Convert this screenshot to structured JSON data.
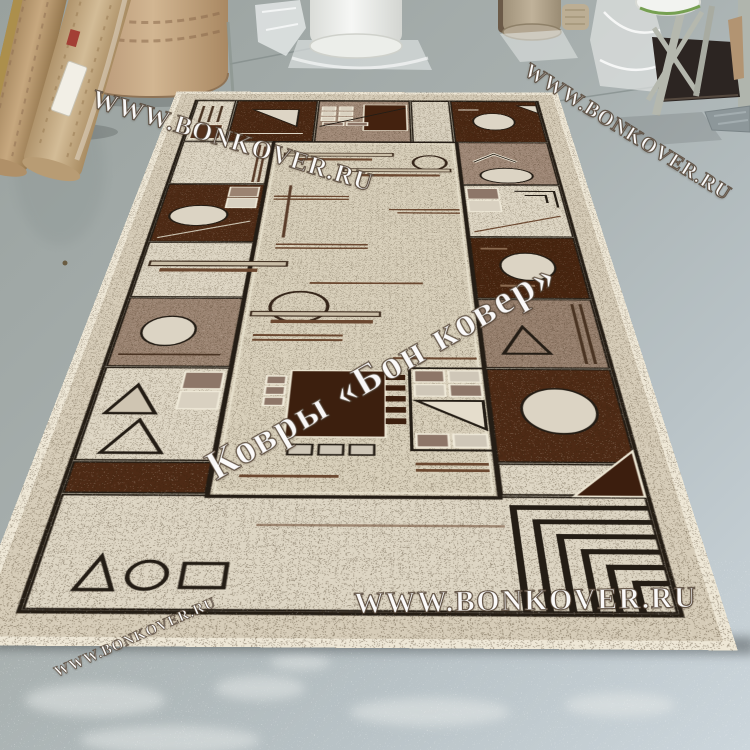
{
  "scene": {
    "description": "Photograph of a beige-brown geometric rug displayed on a gray concrete warehouse floor with rolled carpets and plastic-wrapped rolls in the background",
    "watermarks": {
      "top_left": "WWW.BONKOVER.RU",
      "top_right": "WWW.BONKOVER.RU",
      "center": "Ковры «Бон ковер»",
      "bottom": "WWW.BONKOVER.RU",
      "bottom_left": "WWW.BONKOVER.RU"
    },
    "colors": {
      "floor_top": "#99a19e",
      "floor_bottom_right": "#ccd6dc",
      "rug_binding": "#eee7d6",
      "rug_cream": "#d8cfba",
      "rug_dark_brown": "#47240f",
      "rug_taupe": "#9c8573",
      "rug_outline": "#241d15",
      "watermark_text": "#ffffff"
    }
  }
}
